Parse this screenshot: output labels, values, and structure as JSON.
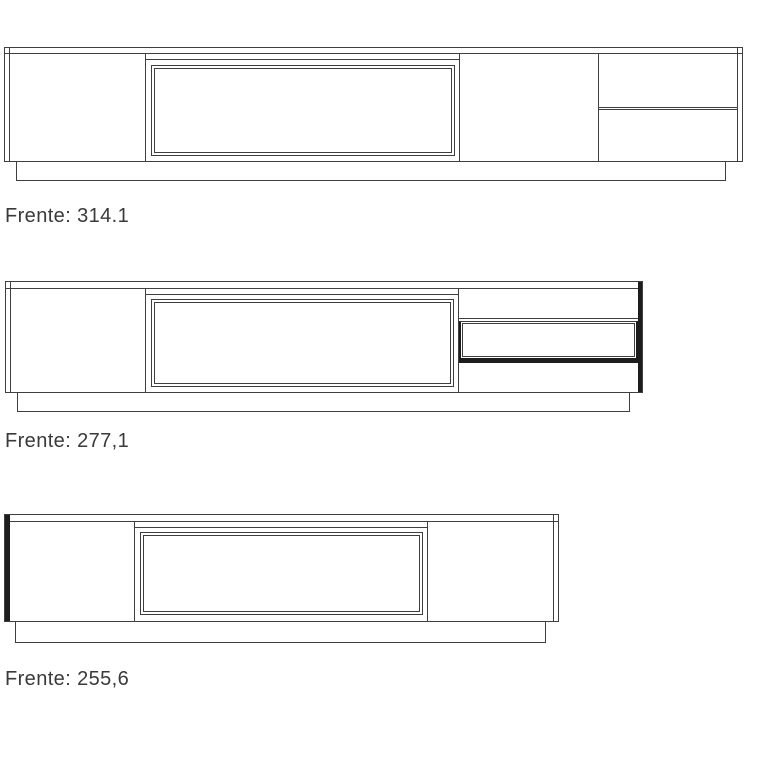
{
  "diagram": {
    "background": "#ffffff",
    "line_color": "#3f3f3f",
    "highlight_color": "#1d1d1d",
    "text_color": "#3a3a3a",
    "drawings": [
      {
        "label": "Frente: 314.1",
        "frente_value": "314.1"
      },
      {
        "label": "Frente: 277,1",
        "frente_value": "277,1"
      },
      {
        "label": "Frente: 255,6",
        "frente_value": "255,6"
      }
    ]
  }
}
